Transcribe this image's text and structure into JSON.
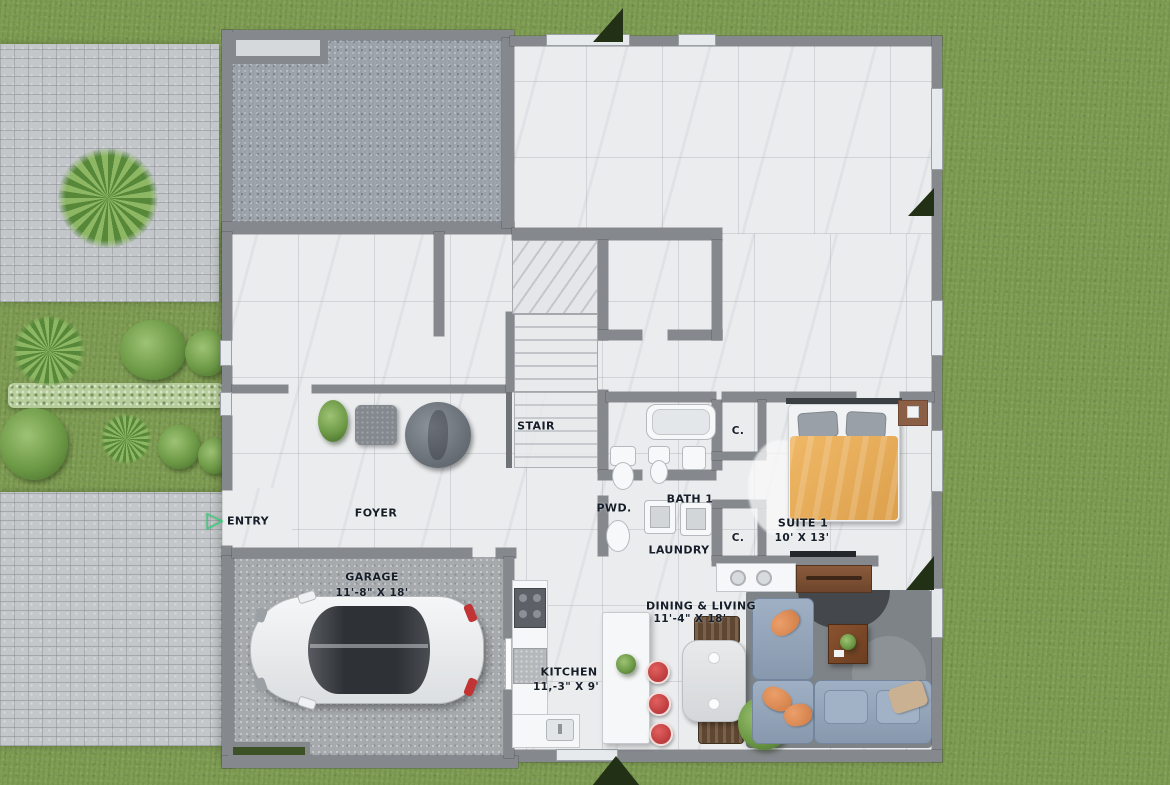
{
  "scene": {
    "description": "3D rendered first-floor plan, top-down view, house with yard",
    "colors": {
      "grass": "#7e9b53",
      "pavers": "#c3c7ca",
      "wall": "#85898e",
      "floor_marble": "#eaecee",
      "bed_duvet": "#e9ae5f",
      "sofa": "#93a5bc",
      "stool_red": "#c2403f",
      "entry_arrow_green": "#27d974"
    },
    "icons": {
      "entry_arrow": "▷"
    }
  },
  "rooms": {
    "entry": {
      "name": "ENTRY"
    },
    "foyer": {
      "name": "FOYER"
    },
    "stair": {
      "name": "STAIR"
    },
    "pwd": {
      "name": "PWD."
    },
    "bath1": {
      "name": "BATH 1"
    },
    "laundry": {
      "name": "LAUNDRY"
    },
    "closet1": {
      "name": "C."
    },
    "closet2": {
      "name": "C."
    },
    "suite1": {
      "name": "SUITE 1",
      "dims": "10' X 13'"
    },
    "garage": {
      "name": "GARAGE",
      "dims": "11'-8\" X 18'"
    },
    "kitchen": {
      "name": "KITCHEN",
      "dims": "11,-3\" X 9'"
    },
    "dining_living": {
      "name": "DINING & LIVING",
      "dims": "11'-4\" X 18'"
    }
  }
}
